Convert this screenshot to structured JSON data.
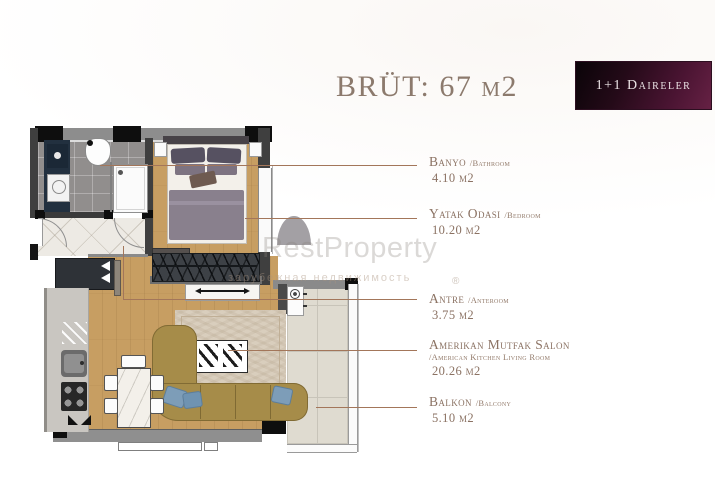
{
  "header": {
    "title": "BRÜT: 67 м2",
    "badge": "1+1 Daireler"
  },
  "watermark": {
    "brand": "RestProperty",
    "tagline": "зарубежная недвижимость",
    "registered": "®"
  },
  "legend": {
    "items": [
      {
        "main": "Banyo",
        "sub": "/Bathroom",
        "area": "4.10 м2"
      },
      {
        "main": "Yatak Odasi",
        "sub": "/Bedroom",
        "area": "10.20 м2"
      },
      {
        "main": "Antre",
        "sub": "/Anteroom",
        "area": "3.75 м2"
      },
      {
        "main": "Amerikan Mutfak Salon",
        "sub": "/American Kitchen Living Room",
        "area": "20.26 м2"
      },
      {
        "main": "Balkon",
        "sub": "/Balcony",
        "area": "5.10 м2"
      }
    ]
  },
  "palette": {
    "badge_maroon": "#5f1c3e",
    "label_text": "#8b7263",
    "leader_line": "#a3765a",
    "wall_dark": "#3f3f3f",
    "wood_floor": "#c79e62",
    "sofa_olive": "#a68c49",
    "pillow_blue": "#7d9db8",
    "watermark_gray": "#dedcda"
  }
}
